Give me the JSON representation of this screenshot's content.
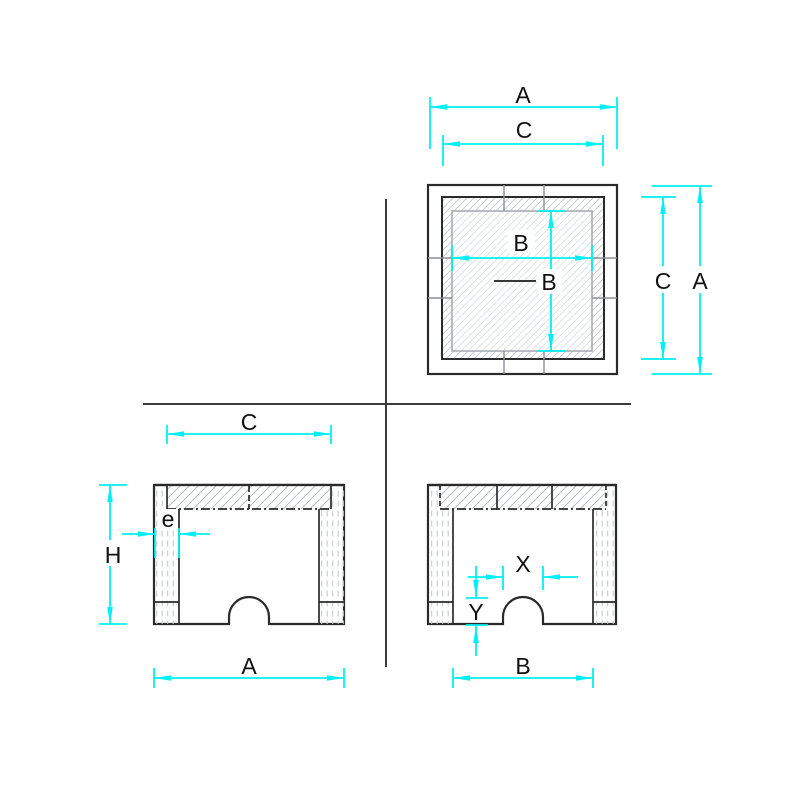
{
  "drawing": {
    "colors": {
      "dimension_lines": "#00f0f5",
      "geometry_lines": "#2a2a2a",
      "joint_lines": "#8a8f94",
      "opening_outline": "#a8adb2",
      "hatch": "#c9ced2",
      "labels": "#101010",
      "background": "#ffffff"
    },
    "labels": {
      "plan": {
        "overall_width": "A",
        "seat_width": "C",
        "opening_width": "B",
        "opening_leader": "B",
        "seat_height": "C",
        "overall_height": "A"
      },
      "front": {
        "seat_width": "C",
        "wall_thickness": "e",
        "height": "H",
        "overall_width": "A"
      },
      "side": {
        "notch_width": "X",
        "notch_height": "Y",
        "opening_width": "B"
      }
    }
  }
}
